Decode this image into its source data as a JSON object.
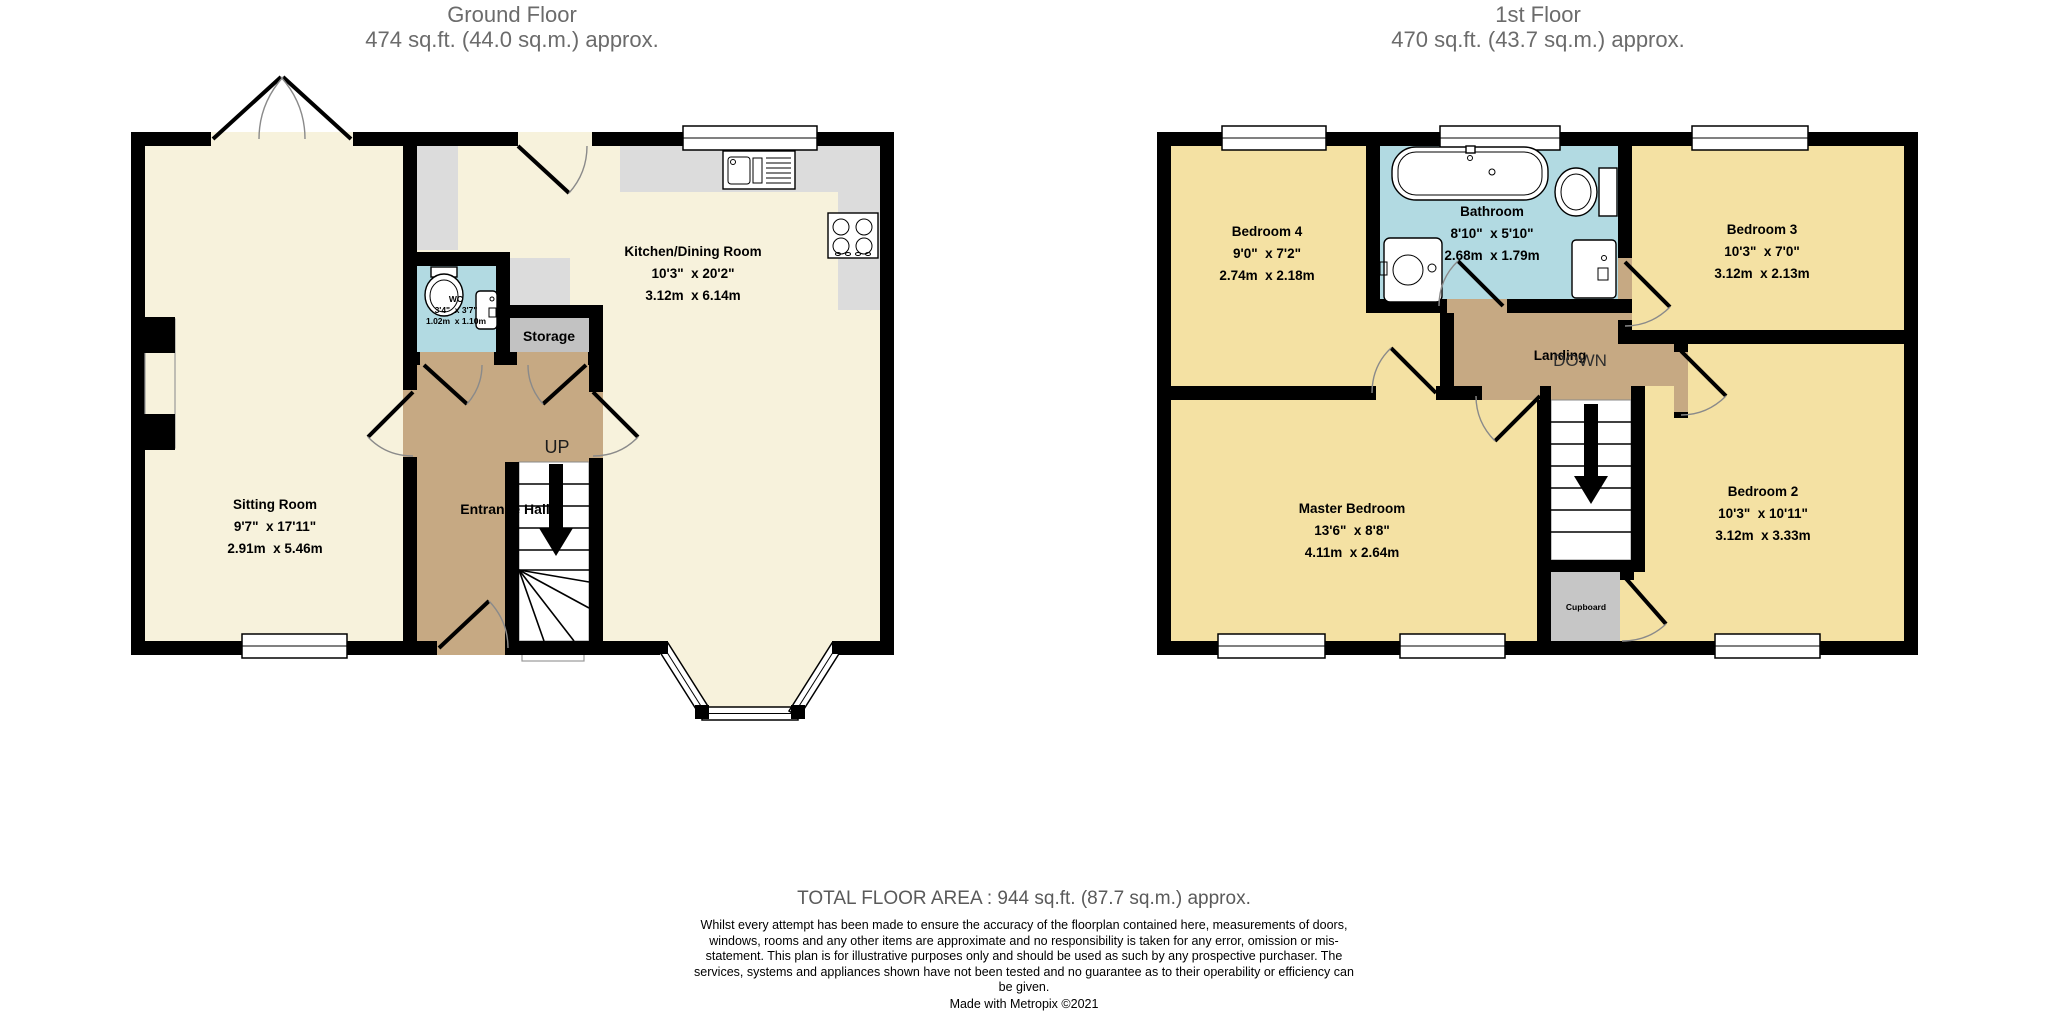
{
  "ground_floor": {
    "title": "Ground Floor",
    "area": "474 sq.ft. (44.0 sq.m.) approx.",
    "rooms": {
      "sitting_room": {
        "name": "Sitting Room",
        "imperial": "9'7\"  x 17'11\"",
        "metric": "2.91m  x 5.46m"
      },
      "kitchen_dining": {
        "name": "Kitchen/Dining Room",
        "imperial": "10'3\"  x 20'2\"",
        "metric": "3.12m  x 6.14m"
      },
      "wc": {
        "name": "WC",
        "imperial": "3'4\"  x 3'7\"",
        "metric": "1.02m  x 1.10m"
      },
      "storage": {
        "name": "Storage"
      },
      "entrance_hall": {
        "name": "Entrance Hall"
      },
      "stairs_label": "UP"
    }
  },
  "first_floor": {
    "title": "1st Floor",
    "area": "470 sq.ft. (43.7 sq.m.) approx.",
    "rooms": {
      "bedroom4": {
        "name": "Bedroom 4",
        "imperial": "9'0\"  x 7'2\"",
        "metric": "2.74m  x 2.18m"
      },
      "bathroom": {
        "name": "Bathroom",
        "imperial": "8'10\"  x 5'10\"",
        "metric": "2.68m  x 1.79m"
      },
      "bedroom3": {
        "name": "Bedroom 3",
        "imperial": "10'3\"  x 7'0\"",
        "metric": "3.12m  x 2.13m"
      },
      "master_bedroom": {
        "name": "Master Bedroom",
        "imperial": "13'6\"  x 8'8\"",
        "metric": "4.11m  x 2.64m"
      },
      "bedroom2": {
        "name": "Bedroom 2",
        "imperial": "10'3\"  x 10'11\"",
        "metric": "3.12m  x 3.33m"
      },
      "landing": {
        "name": "Landing"
      },
      "stairs_label": "DOWN",
      "cupboard": {
        "name": "Cupboard"
      }
    }
  },
  "footer": {
    "total_area": "TOTAL FLOOR AREA : 944 sq.ft. (87.7 sq.m.) approx.",
    "disclaimer": "Whilst every attempt has been made to ensure the accuracy of the floorplan contained here, measurements of doors, windows, rooms and any other items are approximate and no responsibility is taken for any error, omission or mis-statement. This plan is for illustrative purposes only and should be used as such by any prospective purchaser. The services, systems and appliances shown have not been tested and no guarantee as to their operability or efficiency can be given.",
    "credit": "Made with Metropix ©2021"
  },
  "colors": {
    "cream": "#f7f2dc",
    "bedroom_yellow": "#f4e1a3",
    "bath_blue": "#b2dae2",
    "hall_tan": "#c6a983",
    "storage_gray": "#c2c2c2",
    "cupboard_gray": "#c6c6c6",
    "counter_gray": "#dcdcdc",
    "wall_black": "#000000"
  }
}
